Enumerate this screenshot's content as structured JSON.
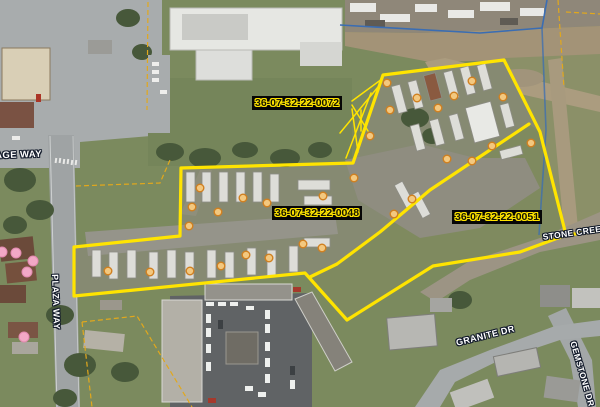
{
  "map": {
    "parcels": [
      {
        "id": "36-07-32-22-0072"
      },
      {
        "id": "36-07-32-22-0048"
      },
      {
        "id": "36-07-32-22-0051"
      }
    ],
    "streets": {
      "village_way": "VILLAGE WAY",
      "plaza_way": "PLAZA WAY",
      "stone_creek": "STONE CREEK",
      "granite_dr": "GRANITE DR",
      "gemstone_dr": "GEMSTONE DR"
    },
    "overlay_colors": {
      "parcel_highlight": "#ffe400",
      "parcel_label_bg": "#060606",
      "thin_parcel_line": "#e2a81c",
      "boundary_blue": "#3a6db3"
    },
    "markers": {
      "unit_fill": "#f3c87f",
      "unit_stroke": "#d07f1f",
      "tree_fill": "#f2a8c6",
      "tree_stroke": "#e189ae",
      "units": [
        [
          200,
          188
        ],
        [
          192,
          207
        ],
        [
          218,
          212
        ],
        [
          189,
          226
        ],
        [
          243,
          198
        ],
        [
          267,
          203
        ],
        [
          323,
          196
        ],
        [
          303,
          244
        ],
        [
          322,
          248
        ],
        [
          108,
          271
        ],
        [
          150,
          272
        ],
        [
          190,
          271
        ],
        [
          221,
          266
        ],
        [
          246,
          255
        ],
        [
          269,
          258
        ],
        [
          387,
          83
        ],
        [
          417,
          98
        ],
        [
          454,
          96
        ],
        [
          472,
          81
        ],
        [
          503,
          97
        ],
        [
          390,
          110
        ],
        [
          438,
          108
        ],
        [
          370,
          136
        ],
        [
          354,
          178
        ],
        [
          492,
          146
        ],
        [
          531,
          143
        ],
        [
          447,
          159
        ],
        [
          472,
          161
        ],
        [
          412,
          199
        ],
        [
          394,
          214
        ]
      ],
      "trees": [
        [
          2,
          252
        ],
        [
          16,
          253
        ],
        [
          33,
          261
        ],
        [
          27,
          272
        ],
        [
          24,
          337
        ]
      ]
    }
  }
}
